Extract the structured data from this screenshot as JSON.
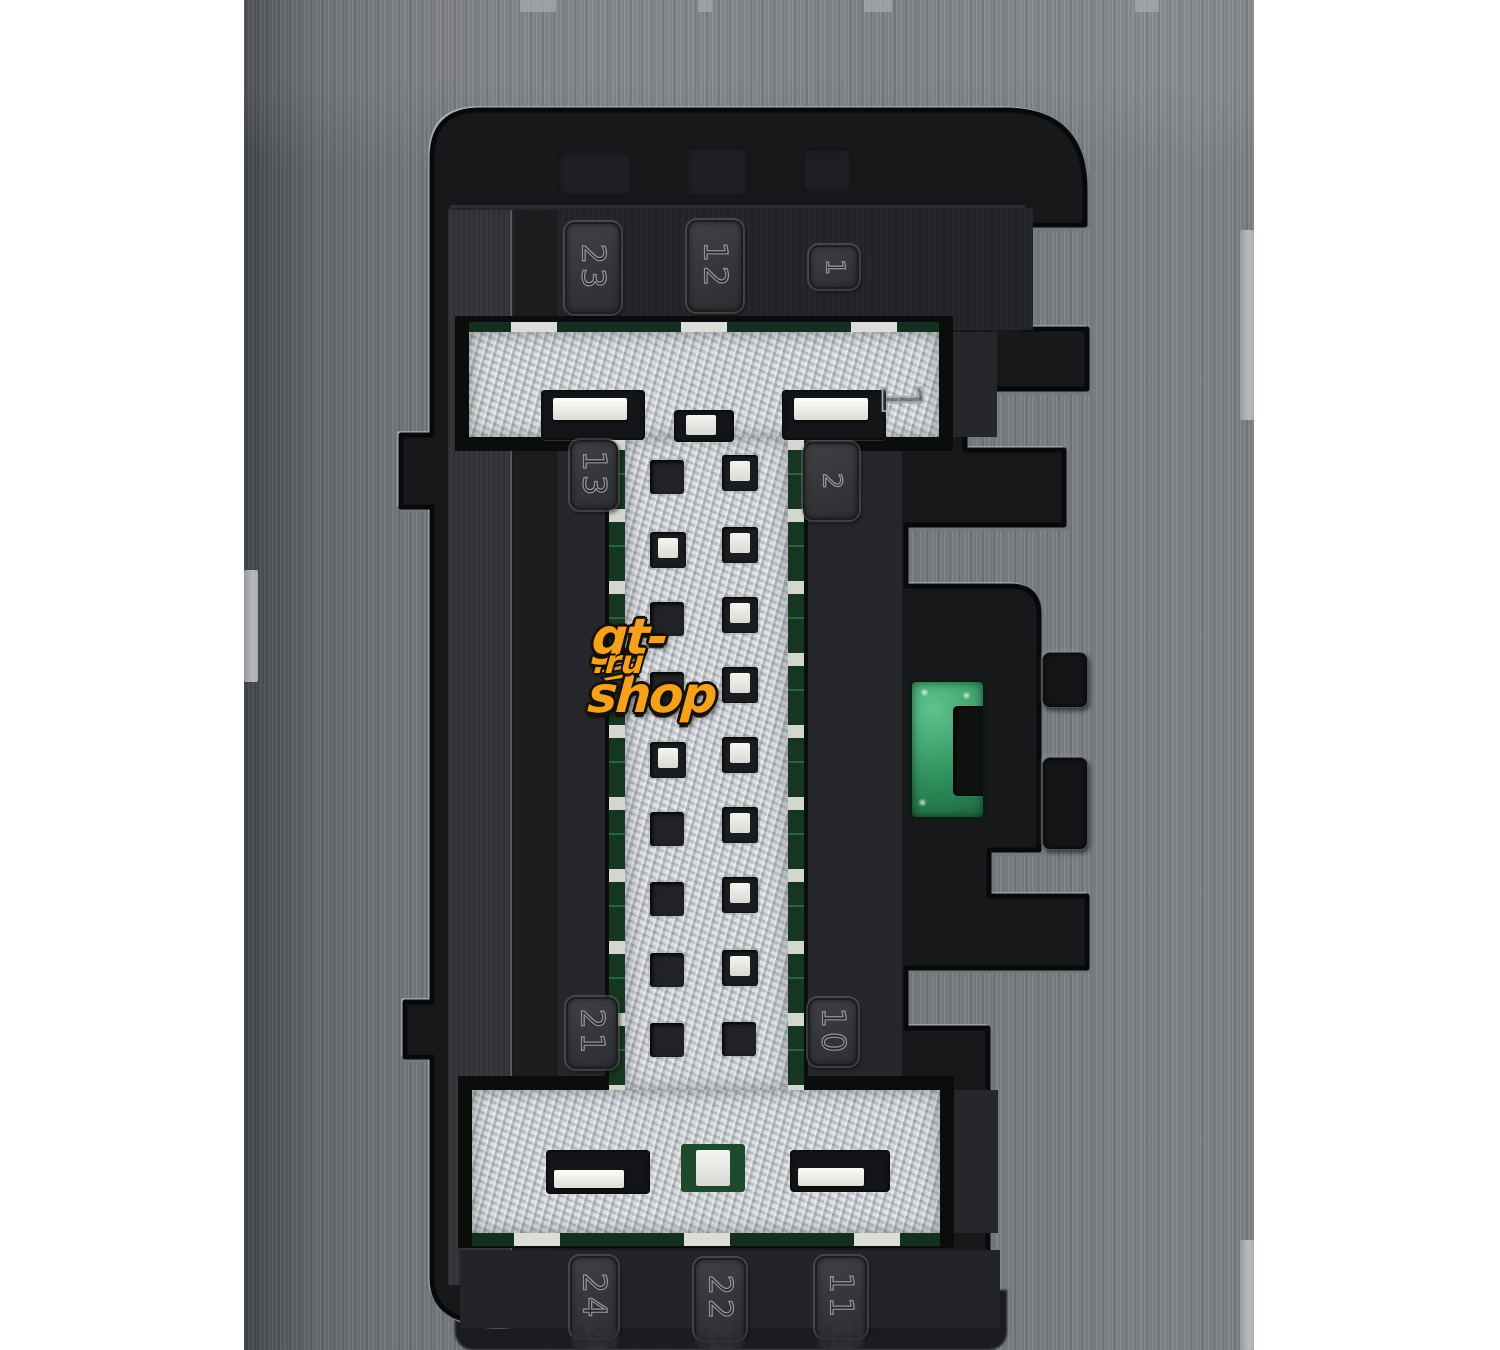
{
  "image": {
    "type": "macro product photograph",
    "subject": "black automotive wiring-harness connector socket (module header) with numbered pin cavities, fibrous molded insert and green PCB visible through openings",
    "canvas": {
      "width": 1500,
      "height": 1350,
      "background": "#ffffff"
    }
  },
  "watermark": {
    "text_main": "gt-shop",
    "text_suffix": ".ru",
    "icon": "speed-wing-icon",
    "color_fill": "#f6a11b",
    "color_outline": "#171006"
  },
  "connector": {
    "cavity_pin_labels": {
      "top_row": [
        "23",
        "12",
        "1"
      ],
      "upper_middle_row": [
        "13",
        "2"
      ],
      "lower_middle_row": [
        "21",
        "10"
      ],
      "bottom_row": [
        "24",
        "22",
        "11"
      ]
    },
    "engraved_mark": "1",
    "pins": {
      "left_column": [
        {
          "y": 460,
          "t": "hole"
        },
        {
          "y": 532,
          "t": "metal"
        },
        {
          "y": 602,
          "t": "hole"
        },
        {
          "y": 672,
          "t": "hole"
        },
        {
          "y": 742,
          "t": "metal"
        },
        {
          "y": 812,
          "t": "hole"
        },
        {
          "y": 882,
          "t": "hole"
        },
        {
          "y": 953,
          "t": "hole"
        },
        {
          "y": 1023,
          "t": "hole"
        }
      ],
      "right_column": [
        {
          "y": 455,
          "t": "metal"
        },
        {
          "y": 527,
          "t": "metal"
        },
        {
          "y": 597,
          "t": "metal"
        },
        {
          "y": 667,
          "t": "metal"
        },
        {
          "y": 737,
          "t": "metal"
        },
        {
          "y": 807,
          "t": "metal"
        },
        {
          "y": 877,
          "t": "metal"
        },
        {
          "y": 950,
          "t": "metal"
        },
        {
          "y": 1022,
          "t": "hole"
        }
      ]
    },
    "colors": {
      "housing_plastic": "#7d8084",
      "cavity_shadow": "#17181a",
      "fiber_insert": "#c3c6ca",
      "pcb_green_bright": "#3fa06c",
      "pcb_green_dark": "#173822",
      "terminal_metal": "#ececea"
    }
  }
}
